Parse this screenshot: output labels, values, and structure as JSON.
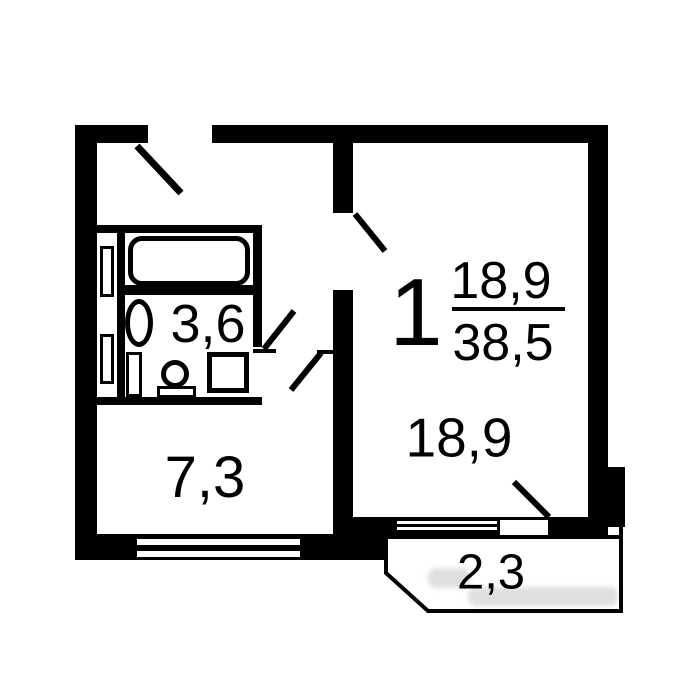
{
  "floorplan": {
    "room_number": "1",
    "area_fraction": {
      "numerator": "18,9",
      "denominator": "38,5"
    },
    "living_room": {
      "area_label": "18,9"
    },
    "kitchen": {
      "area_label": "7,3"
    },
    "bathroom": {
      "area_label": "3,6"
    },
    "balcony": {
      "area_label": "2,3"
    },
    "colors": {
      "wall": "#000000",
      "background": "#ffffff",
      "watermark_gray": "#8f8f8f"
    }
  }
}
